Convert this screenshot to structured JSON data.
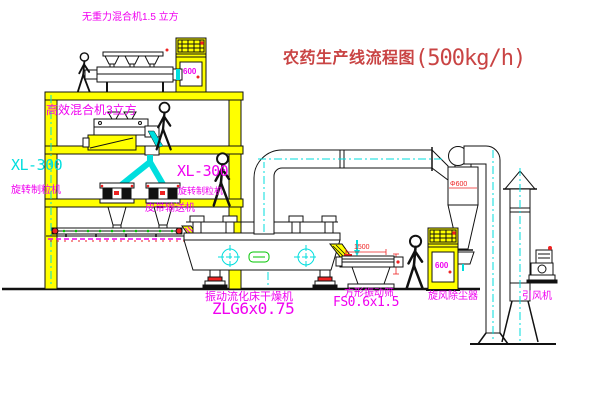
{
  "title": {
    "text": "农药生产线流程图",
    "capacity": "(500kg/h)"
  },
  "colors": {
    "label_magenta": "#f000f0",
    "line_cyan": "#00e0e0",
    "machine_yellow": "#ffff00",
    "title_red": "#c94444",
    "accent_red": "#ee2222",
    "accent_green": "#00c400"
  },
  "equipment": {
    "top_mixer": {
      "label": "无重力混合机1.5 立方"
    },
    "mid_mixer": {
      "label": "高效混合机3立方"
    },
    "granulator_left": {
      "model": "XL-300",
      "label": "旋转制粒机"
    },
    "granulator_right": {
      "model": "XL-300",
      "label": "旋转制粒机"
    },
    "conveyor": {
      "label": "皮带输送机"
    },
    "dryer": {
      "label": "振动流化床干燥机",
      "model": "ZLG6x0.75"
    },
    "screen": {
      "label": "方形振动筛",
      "model": "FS0.6x1.5",
      "dim_width": "1500"
    },
    "cyclone": {
      "label": "旋风除尘器",
      "diameter": "Φ600"
    },
    "fan": {
      "label": "引风机"
    },
    "cabinet_top": {
      "tag": "600"
    },
    "cabinet_right": {
      "tag": "600"
    }
  }
}
